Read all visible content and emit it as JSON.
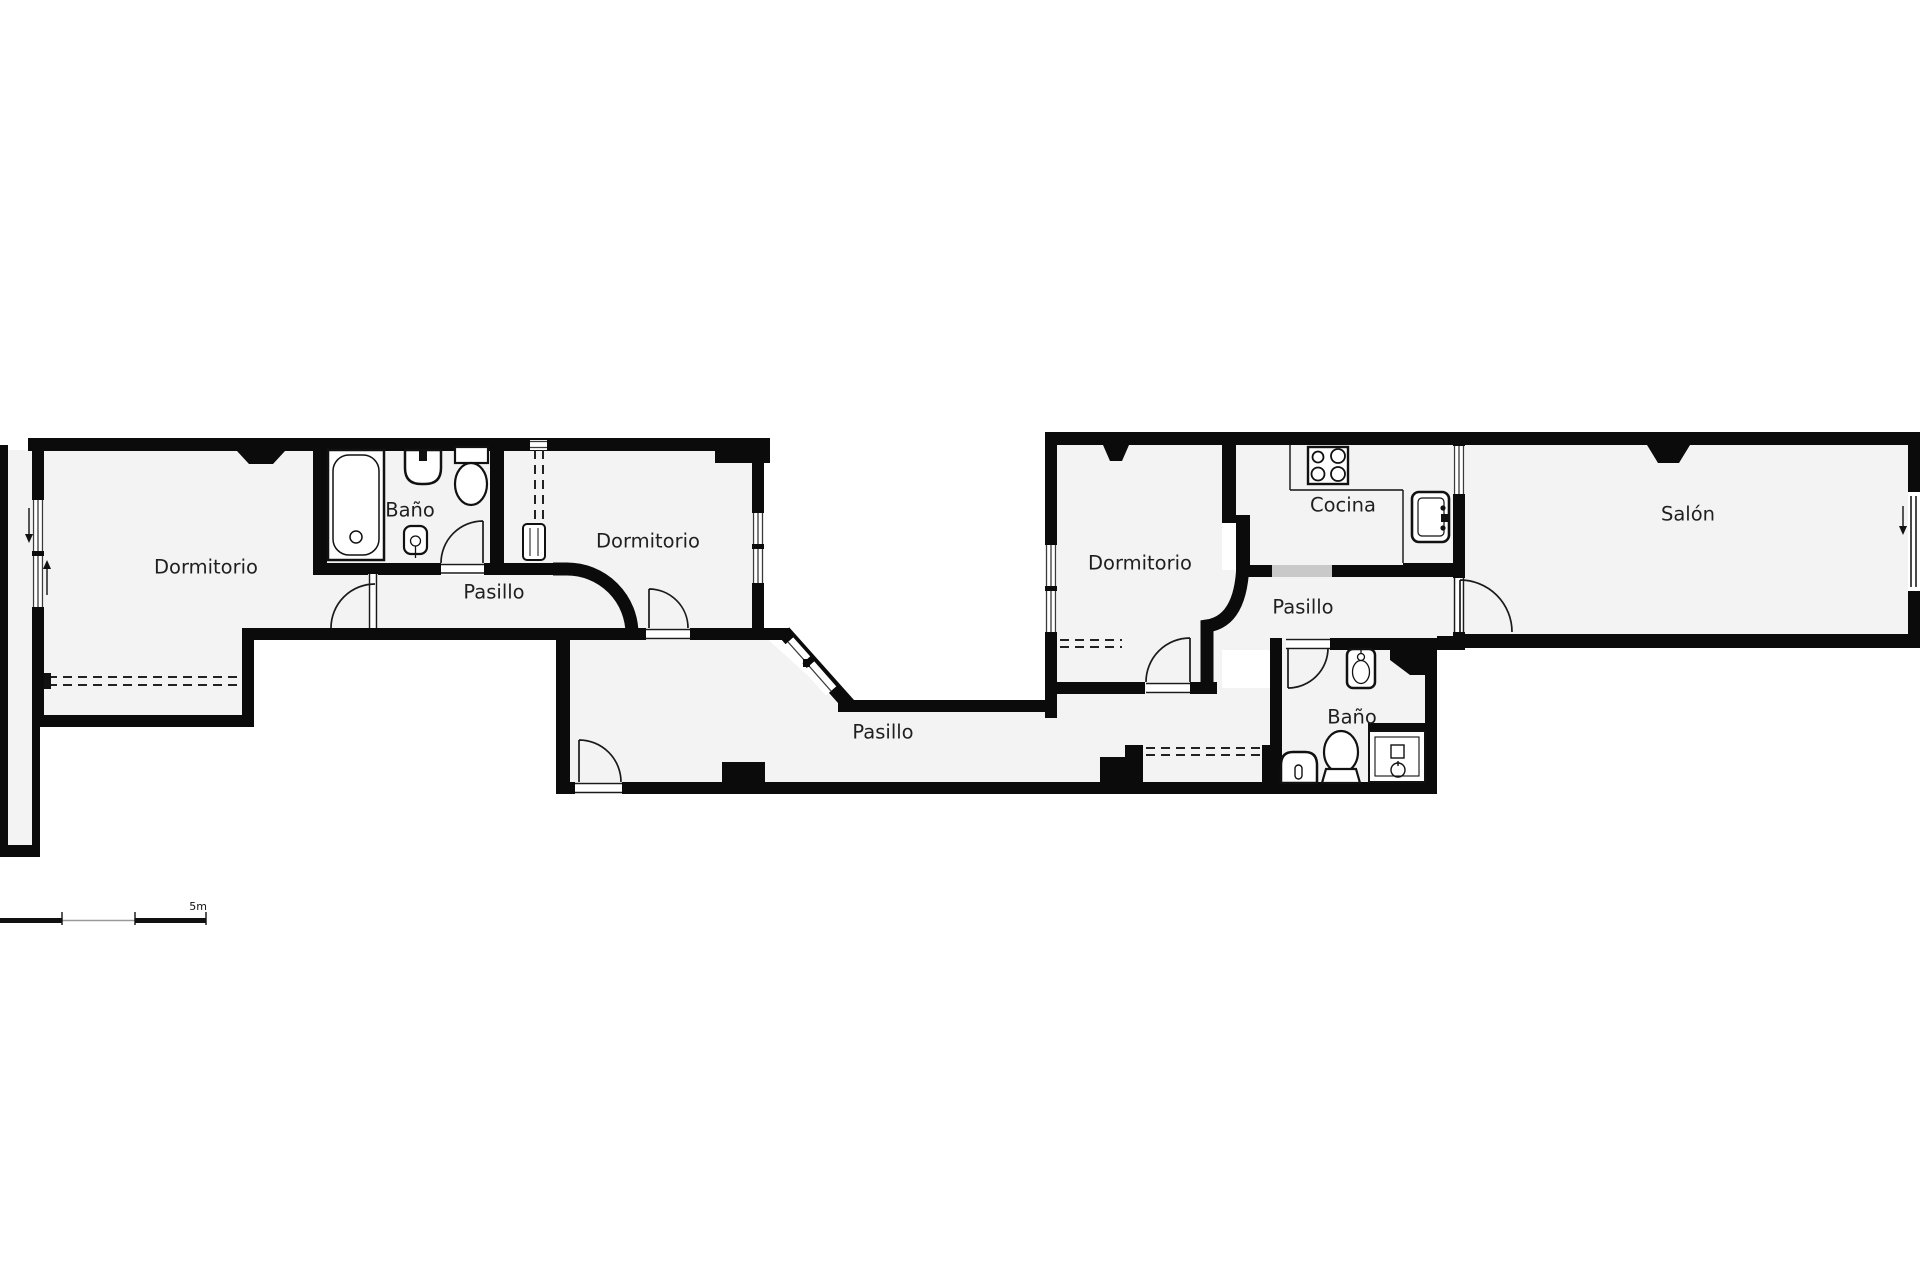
{
  "palette": {
    "wall": "#0b0b0b",
    "floor": "#f3f3f3",
    "bg": "#ffffff",
    "line": "#1a1a1a",
    "opening": "#c9c9c9",
    "text": "#1f1f1f"
  },
  "plan": {
    "type": "apartment-floorplan",
    "rooms": [
      {
        "id": "dormitorio-izquierda",
        "label": "Dormitorio"
      },
      {
        "id": "bano-izquierda",
        "label": "Baño"
      },
      {
        "id": "pasillo-izquierda",
        "label": "Pasillo"
      },
      {
        "id": "dormitorio-centro",
        "label": "Dormitorio"
      },
      {
        "id": "pasillo-central",
        "label": "Pasillo"
      },
      {
        "id": "dormitorio-derecha",
        "label": "Dormitorio"
      },
      {
        "id": "cocina",
        "label": "Cocina"
      },
      {
        "id": "pasillo-derecha",
        "label": "Pasillo"
      },
      {
        "id": "bano-derecha",
        "label": "Baño"
      },
      {
        "id": "salon",
        "label": "Salón"
      }
    ],
    "fixtures": [
      "bathtub-icon",
      "washbasin-icon",
      "toilet-icon",
      "bidet-icon",
      "stove-icon",
      "kitchen-sink-icon",
      "shower-icon",
      "radiator-icon"
    ],
    "scale_bar": {
      "label": "5m"
    }
  }
}
